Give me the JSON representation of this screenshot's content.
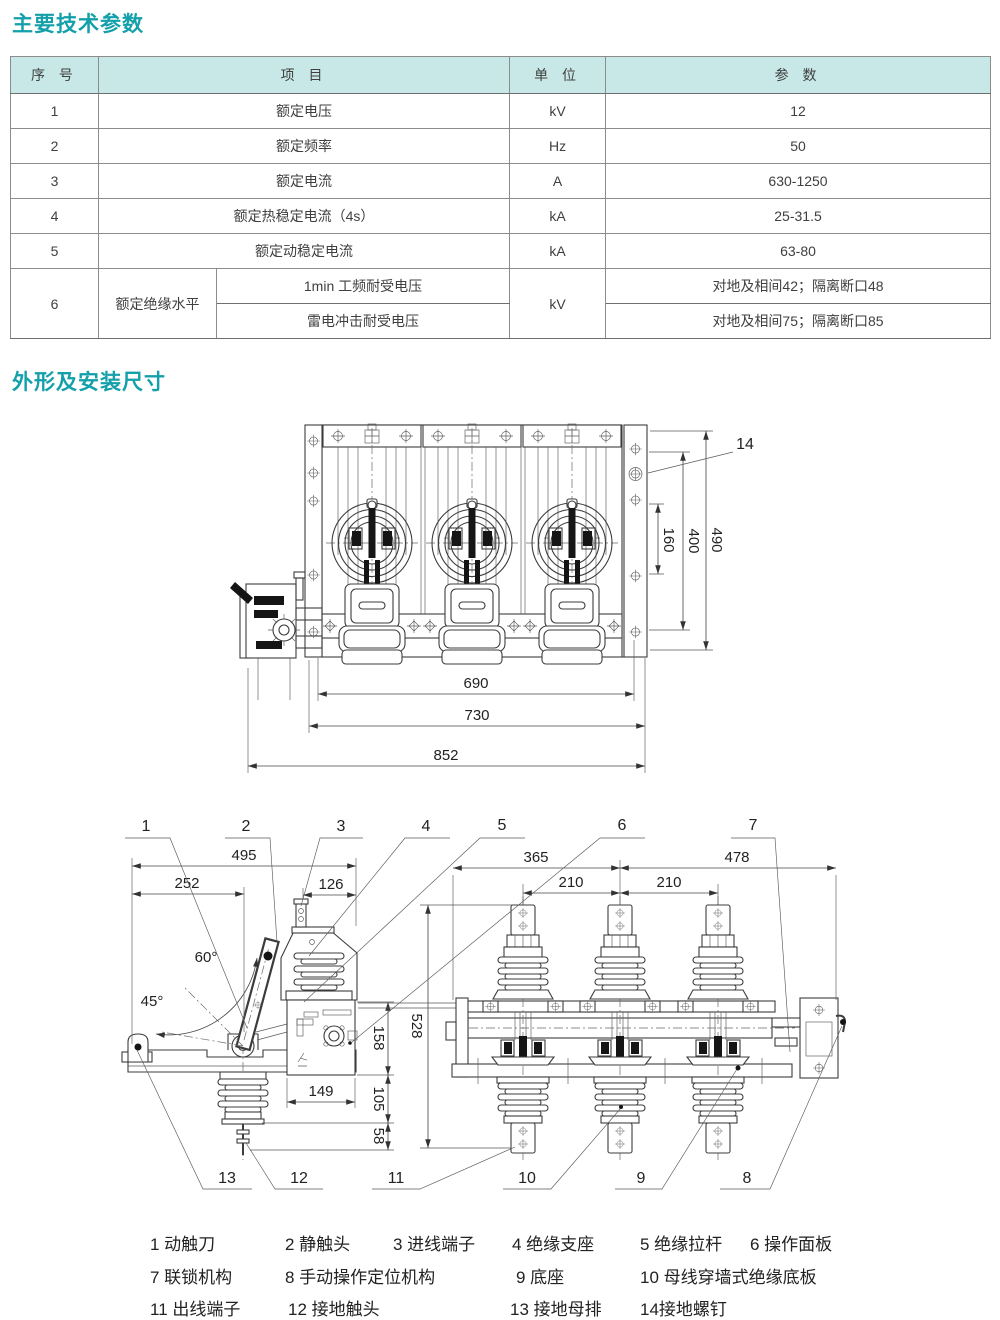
{
  "page": {
    "title1": "主要技术参数",
    "title2": "外形及安装尺寸",
    "accent": "#14a0aa"
  },
  "table": {
    "headers": [
      "序 号",
      "项 目",
      "单 位",
      "参 数"
    ],
    "rows": [
      {
        "no": "1",
        "item": "额定电压",
        "unit": "kV",
        "value": "12"
      },
      {
        "no": "2",
        "item": "额定频率",
        "unit": "Hz",
        "value": "50"
      },
      {
        "no": "3",
        "item": "额定电流",
        "unit": "A",
        "value": "630-1250"
      },
      {
        "no": "4",
        "item": "额定热稳定电流（4s）",
        "unit": "kA",
        "value": "25-31.5"
      },
      {
        "no": "5",
        "item": "额定动稳定电流",
        "unit": "kA",
        "value": "63-80"
      }
    ],
    "row6": {
      "no": "6",
      "group": "额定绝缘水平",
      "unit": "kV",
      "sub": [
        {
          "item": "1min 工频耐受电压",
          "value": "对地及相间42；隔离断口48"
        },
        {
          "item": "雷电冲击耐受电压",
          "value": "对地及相间75；隔离断口85"
        }
      ]
    }
  },
  "drawing1": {
    "label14": "14",
    "dims": {
      "h160": "160",
      "h400": "400",
      "h490": "490",
      "w690": "690",
      "w730": "730",
      "w852": "852"
    }
  },
  "drawing2": {
    "callouts_top": [
      "1",
      "2",
      "3",
      "4",
      "5",
      "6",
      "7"
    ],
    "callouts_bottom": [
      "13",
      "12",
      "11",
      "10",
      "9",
      "8"
    ],
    "dims": {
      "w495": "495",
      "w252": "252",
      "w126": "126",
      "ang60": "60°",
      "ang45": "45°",
      "h158": "158",
      "h105": "105",
      "h58": "58",
      "w149": "149",
      "h528": "528",
      "w365": "365",
      "w478": "478",
      "w210a": "210",
      "w210b": "210"
    }
  },
  "legend": {
    "rows": [
      [
        "1 动触刀",
        "2 静触头",
        "3 进线端子",
        "4 绝缘支座",
        "5 绝缘拉杆",
        "6 操作面板"
      ],
      [
        "7 联锁机构",
        "8 手动操作定位机构",
        "9 底座",
        "10 母线穿墙式绝缘底板"
      ],
      [
        "11 出线端子",
        "12 接地触头",
        "13 接地母排",
        "14接地螺钉"
      ]
    ]
  }
}
